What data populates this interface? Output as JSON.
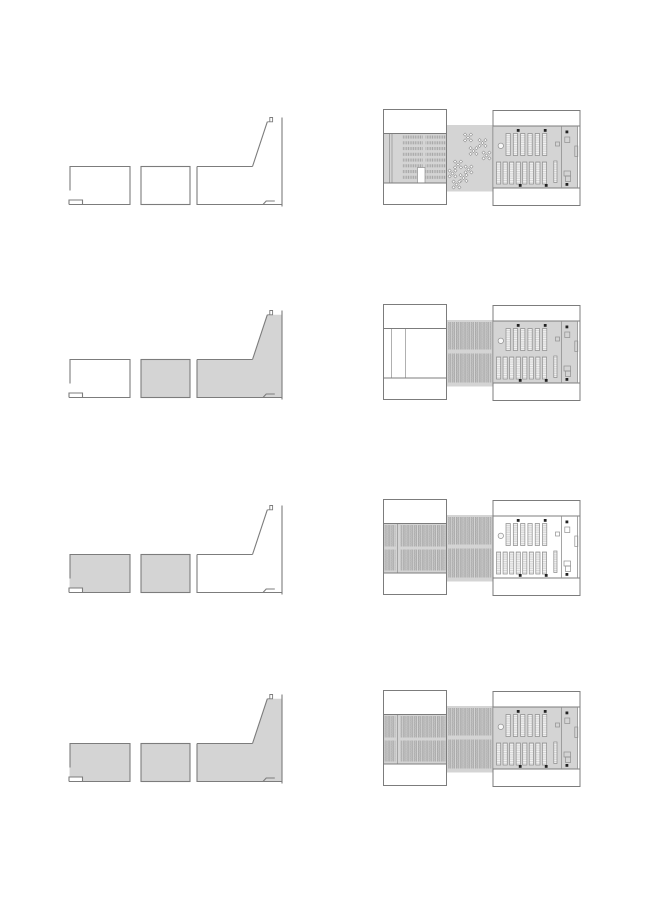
{
  "canvas": {
    "width": 650,
    "height": 919,
    "background": "#ffffff"
  },
  "colors": {
    "fill_gray": "#d4d4d4",
    "line": "#7c7c7c",
    "line_light": "#8f8f8f",
    "dot_black": "#222222",
    "white": "#ffffff",
    "seat_bg": "#c9c9c9",
    "seat_tick": "#999999",
    "stack_bg": "#c3c3c3",
    "stack_line": "#979797",
    "stack_rung": "#b4b4b4",
    "shelf_bg": "#f4f4f4",
    "shelf_rung": "#bdbdbd",
    "strip_stroke": "#8c8c8c"
  },
  "rows": [
    {
      "id": "phase-1",
      "section_filled": {
        "left": false,
        "middle": false,
        "right": false
      },
      "plan": {
        "left_content": "auditorium-seating",
        "left_gray": true,
        "connector_content": "scattered-tables",
        "connector_gray": true,
        "right_content": "library-stacks",
        "right_gray": true
      }
    },
    {
      "id": "phase-2",
      "section_filled": {
        "left": false,
        "middle": true,
        "right": true
      },
      "plan": {
        "left_content": "empty",
        "left_gray": false,
        "connector_content": "dense-stacks",
        "connector_gray": true,
        "right_content": "library-stacks",
        "right_gray": true
      }
    },
    {
      "id": "phase-3",
      "section_filled": {
        "left": true,
        "middle": true,
        "right": false
      },
      "plan": {
        "left_content": "dense-stacks",
        "left_gray": true,
        "connector_content": "dense-stacks",
        "connector_gray": true,
        "right_content": "library-stacks",
        "right_gray": false
      }
    },
    {
      "id": "phase-4",
      "section_filled": {
        "left": true,
        "middle": true,
        "right": true
      },
      "plan": {
        "left_content": "dense-stacks",
        "left_gray": true,
        "connector_content": "dense-stacks",
        "connector_gray": true,
        "right_content": "library-stacks",
        "right_gray": true
      }
    }
  ],
  "section_row_offsets": [
    0,
    193,
    388,
    577
  ],
  "plan_row_offsets": [
    0,
    195,
    390,
    581
  ],
  "table_cluster_count": 9,
  "top_strip_count": 6,
  "bottom_strip_count": 8,
  "seat_row_count": 8
}
